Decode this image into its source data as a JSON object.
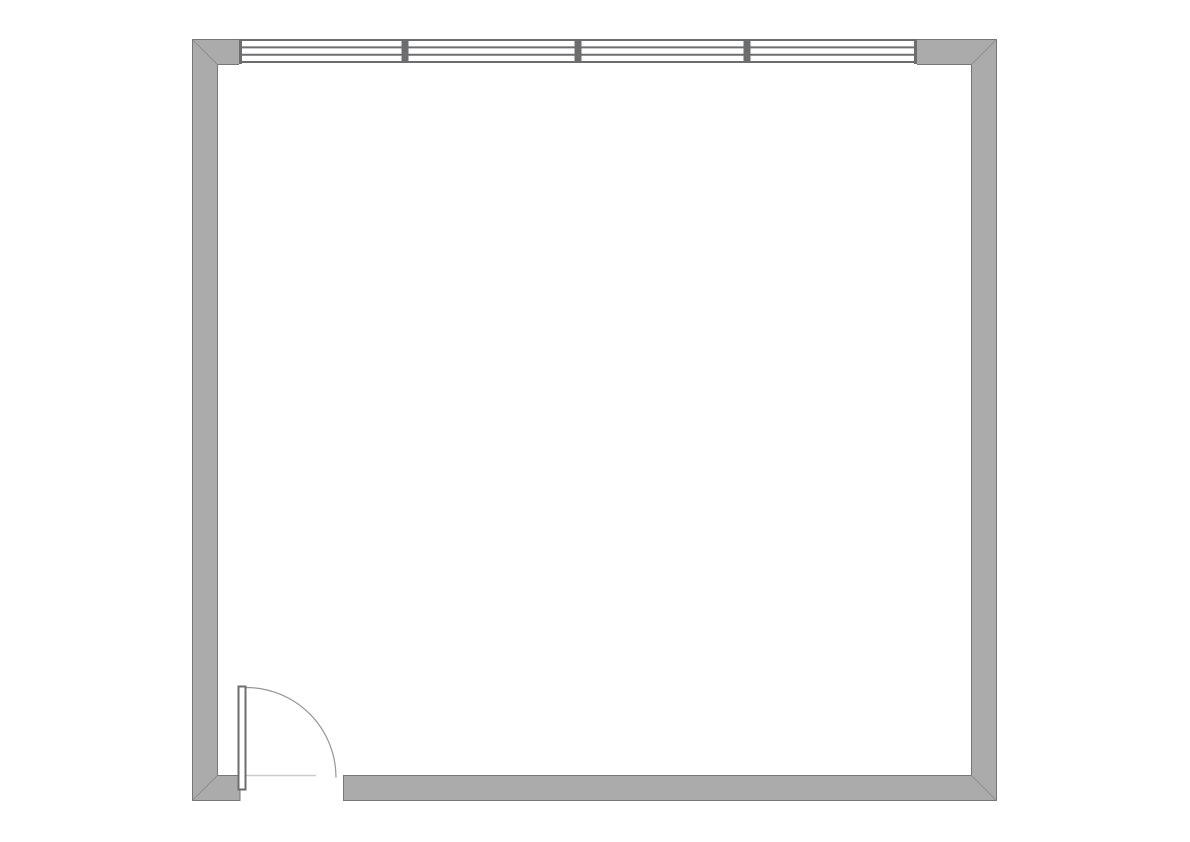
{
  "canvas": {
    "width": 1190,
    "height": 842,
    "background": "#ffffff"
  },
  "plan": {
    "type": "floor-plan",
    "description": "Plan view of a single square room with a four-pane window centered on the top wall and a single swing door at the left end of the bottom wall, opening into the room",
    "room_outer": {
      "x": 192,
      "y": 39,
      "width": 805,
      "height": 762
    },
    "wall_thickness": 26
  },
  "colors": {
    "background": "#ffffff",
    "wall_fill": "#ababab",
    "wall_outline": "#747678",
    "miter_line": "#8e9092",
    "window_line": "#6b6d6f",
    "mullion_fill": "#6b6d6f",
    "window_frame": "#6b6d6f",
    "door_outline": "#6b6d6f",
    "door_fill": "#ffffff",
    "swing_arc": "#949698",
    "threshold_line": "#c9cbcd"
  },
  "walls": {
    "left": {
      "x": 192,
      "y": 39,
      "width": 26,
      "height": 762
    },
    "right": {
      "x": 971,
      "y": 39,
      "width": 26,
      "height": 762
    },
    "top_left": {
      "x": 192,
      "y": 39,
      "width": 47,
      "height": 26
    },
    "top_right": {
      "x": 917,
      "y": 39,
      "width": 80,
      "height": 26
    },
    "bottom_left": {
      "x": 192,
      "y": 775,
      "width": 48,
      "height": 26
    },
    "bottom_right": {
      "x": 343,
      "y": 775,
      "width": 654,
      "height": 26
    }
  },
  "outline": {
    "stroke_width": 1,
    "lines": [
      {
        "x1": 192.5,
        "y1": 39,
        "x2": 192.5,
        "y2": 801
      },
      {
        "x1": 996.5,
        "y1": 39,
        "x2": 996.5,
        "y2": 801
      },
      {
        "x1": 192,
        "y1": 39.5,
        "x2": 997,
        "y2": 39.5
      },
      {
        "x1": 192,
        "y1": 800.5,
        "x2": 240,
        "y2": 800.5
      },
      {
        "x1": 343,
        "y1": 800.5,
        "x2": 997,
        "y2": 800.5
      },
      {
        "x1": 217.5,
        "y1": 64.5,
        "x2": 239,
        "y2": 64.5
      },
      {
        "x1": 917,
        "y1": 64.5,
        "x2": 971.5,
        "y2": 64.5
      },
      {
        "x1": 217.5,
        "y1": 65,
        "x2": 217.5,
        "y2": 775
      },
      {
        "x1": 971.5,
        "y1": 65,
        "x2": 971.5,
        "y2": 775
      },
      {
        "x1": 217.5,
        "y1": 775.5,
        "x2": 240,
        "y2": 775.5
      },
      {
        "x1": 343,
        "y1": 775.5,
        "x2": 971.5,
        "y2": 775.5
      },
      {
        "x1": 240,
        "y1": 775,
        "x2": 240,
        "y2": 801
      },
      {
        "x1": 343.5,
        "y1": 775,
        "x2": 343.5,
        "y2": 801
      }
    ]
  },
  "miters": {
    "stroke_width": 1,
    "top_left": {
      "x1": 192.5,
      "y1": 39.5,
      "x2": 217.5,
      "y2": 64.5
    },
    "top_right": {
      "x1": 996.5,
      "y1": 39.5,
      "x2": 971.5,
      "y2": 64.5
    },
    "bottom_right": {
      "x1": 996.5,
      "y1": 800.5,
      "x2": 971.5,
      "y2": 775.5
    },
    "bottom_left": {
      "x1": 192.5,
      "y1": 800.5,
      "x2": 217.5,
      "y2": 775.5
    }
  },
  "window": {
    "x": 239,
    "y": 39,
    "width": 678,
    "height": 26,
    "pane_count": 4,
    "line_stroke_width": 2,
    "lines": [
      {
        "x1": 240,
        "y1": 40,
        "x2": 916,
        "y2": 40
      },
      {
        "x1": 240,
        "y1": 47.4,
        "x2": 916,
        "y2": 47.4
      },
      {
        "x1": 240,
        "y1": 54.7,
        "x2": 916,
        "y2": 54.7
      },
      {
        "x1": 240,
        "y1": 62,
        "x2": 916,
        "y2": 62
      }
    ],
    "mullions": [
      {
        "x": 401.5,
        "y": 40,
        "width": 7,
        "height": 22
      },
      {
        "x": 574.5,
        "y": 40,
        "width": 7,
        "height": 22
      },
      {
        "x": 743.5,
        "y": 40,
        "width": 7,
        "height": 22
      }
    ],
    "frames": [
      {
        "x": 239,
        "y": 39,
        "width": 3,
        "height": 25
      },
      {
        "x": 914,
        "y": 39,
        "width": 3,
        "height": 25
      }
    ]
  },
  "door": {
    "opening": {
      "x1": 240,
      "x2": 343,
      "y": 775
    },
    "leaf": {
      "x": 238.5,
      "y": 686.5,
      "width": 7,
      "height": 103,
      "stroke_width": 2
    },
    "swing_arc": {
      "path": "M 246 687.5 A 90 90 0 0 1 336 777.5",
      "stroke_width": 1.2
    },
    "threshold": {
      "x1": 246,
      "y1": 775.5,
      "x2": 316,
      "y2": 775.5,
      "stroke_width": 1.5
    }
  }
}
